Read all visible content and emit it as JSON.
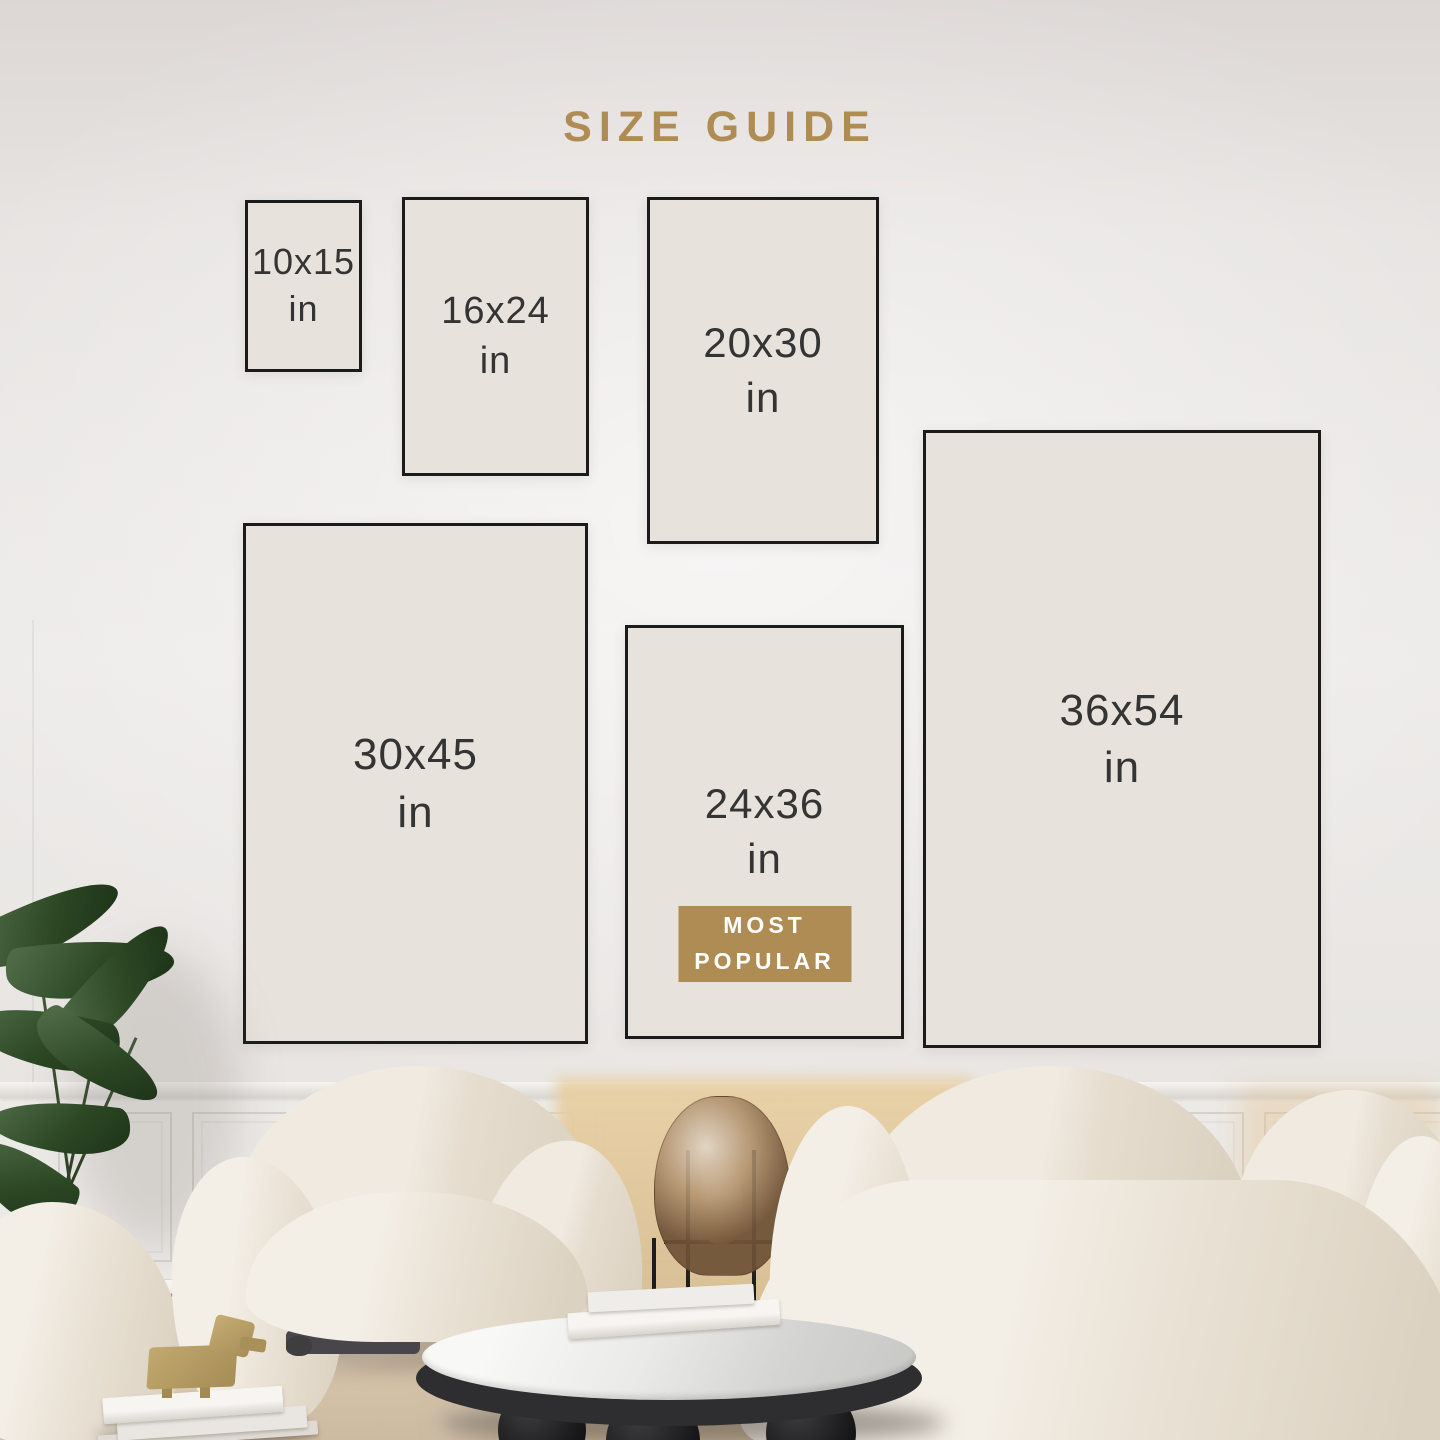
{
  "title": {
    "label": "SIZE GUIDE"
  },
  "sizes": [
    {
      "label": "10x15",
      "unit": "in"
    },
    {
      "label": "16x24",
      "unit": "in"
    },
    {
      "label": "20x30",
      "unit": "in"
    },
    {
      "label": "36x54",
      "unit": "in"
    },
    {
      "label": "30x45",
      "unit": "in"
    },
    {
      "label": "24x36",
      "unit": "in",
      "most_popular": true
    }
  ],
  "badge": {
    "line1": "MOST",
    "line2": "POPULAR"
  },
  "colors": {
    "accent_gold": "#b08c55",
    "box_fill": "#e7e2db",
    "box_border": "#1b1b1b",
    "size_text": "#343434",
    "badge_text": "#ffffff"
  }
}
